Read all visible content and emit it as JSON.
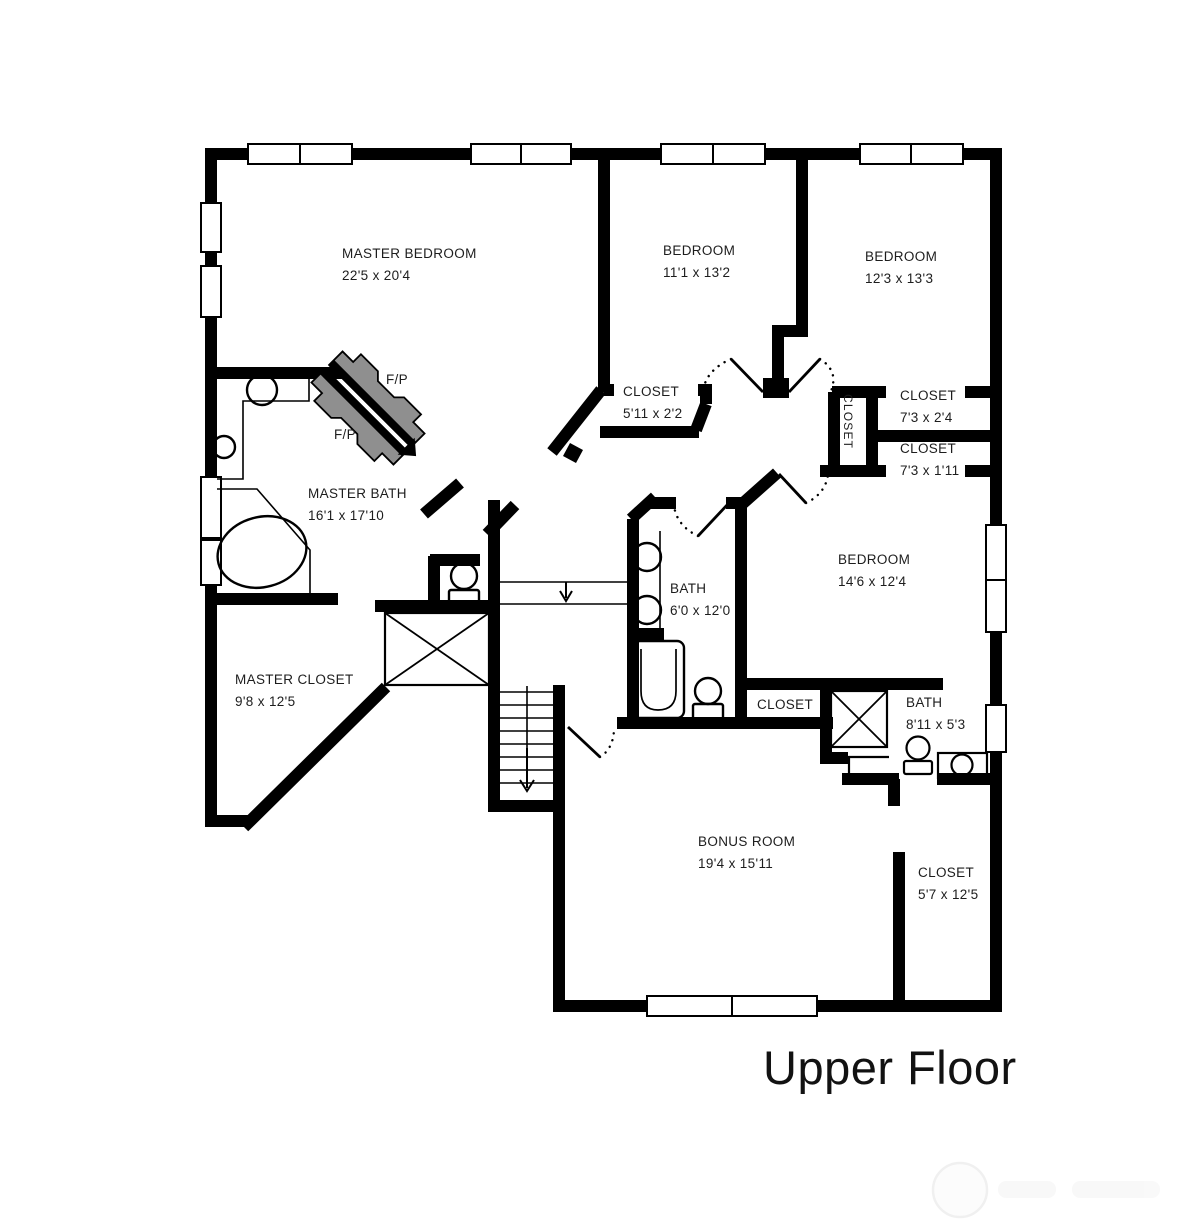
{
  "title": "Upper Floor",
  "colors": {
    "wall": "#000000",
    "fireplace_gray": "#8f8f8f",
    "text": "#1d1d1d",
    "background": "#ffffff",
    "watermark": "#ebebeb"
  },
  "rooms": {
    "master_bedroom": {
      "name": "MASTER BEDROOM",
      "dims": "22'5 x 20'4"
    },
    "bedroom_small": {
      "name": "BEDROOM",
      "dims": "11'1 x 13'2"
    },
    "bedroom_mid": {
      "name": "BEDROOM",
      "dims": "12'3 x 13'3"
    },
    "bedroom_right": {
      "name": "BEDROOM",
      "dims": "14'6 x 12'4"
    },
    "master_bath": {
      "name": "MASTER BATH",
      "dims": "16'1 x 17'10"
    },
    "master_closet": {
      "name": "MASTER CLOSET",
      "dims": "9'8 x 12'5"
    },
    "closet_bedroom_small": {
      "name": "CLOSET",
      "dims": "5'11 x 2'2"
    },
    "closet_right_upper": {
      "name": "CLOSET",
      "dims": "7'3 x 2'4"
    },
    "closet_right_lower": {
      "name": "CLOSET",
      "dims": "7'3 x 1'11"
    },
    "closet_shaft": {
      "name": "CLOSET"
    },
    "closet_hall": {
      "name": "CLOSET"
    },
    "hall_bath": {
      "name": "BATH",
      "dims": "6'0 x 12'0"
    },
    "small_bath": {
      "name": "BATH",
      "dims": "8'11 x 5'3"
    },
    "bonus_room": {
      "name": "BONUS ROOM",
      "dims": "19'4 x 15'11"
    },
    "closet_bonus": {
      "name": "CLOSET",
      "dims": "5'7 x 12'5"
    }
  },
  "fireplace": {
    "label_upper": "F/P",
    "label_lower": "F/P"
  }
}
